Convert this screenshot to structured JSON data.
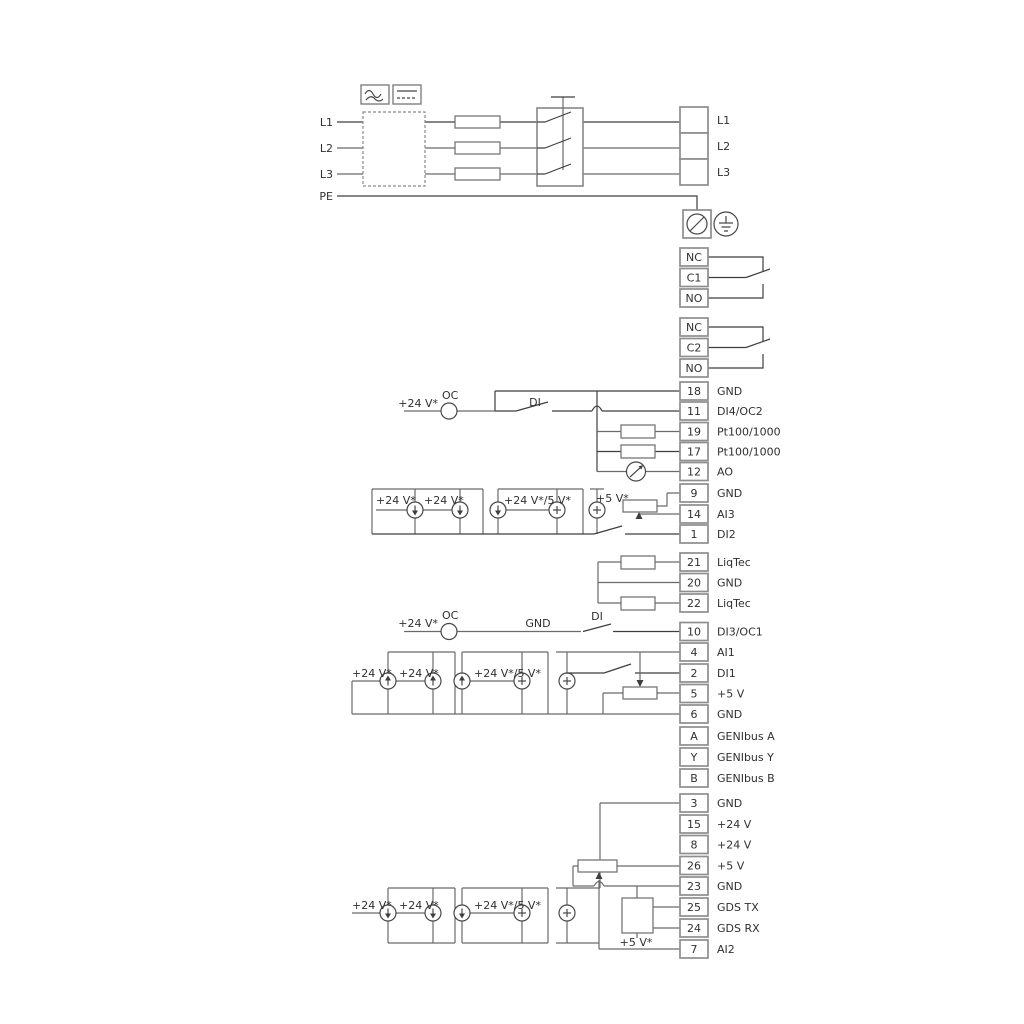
{
  "diagram": {
    "mains_input": {
      "l1": "L1",
      "l2": "L2",
      "l3": "L3",
      "pe": "PE"
    },
    "mains_output": {
      "items": [
        {
          "label": "L1"
        },
        {
          "label": "L2"
        },
        {
          "label": "L3"
        }
      ]
    },
    "relay1": {
      "items": [
        {
          "num": "NC"
        },
        {
          "num": "C1"
        },
        {
          "num": "NO"
        }
      ]
    },
    "relay2": {
      "items": [
        {
          "num": "NC"
        },
        {
          "num": "C2"
        },
        {
          "num": "NO"
        }
      ]
    },
    "io_a": {
      "items": [
        {
          "num": "18",
          "label": "GND"
        },
        {
          "num": "11",
          "label": "DI4/OC2"
        },
        {
          "num": "19",
          "label": "Pt100/1000"
        },
        {
          "num": "17",
          "label": "Pt100/1000"
        },
        {
          "num": "12",
          "label": "AO"
        },
        {
          "num": "9",
          "label": "GND"
        },
        {
          "num": "14",
          "label": "AI3"
        },
        {
          "num": "1",
          "label": "DI2"
        }
      ]
    },
    "liqtec": {
      "items": [
        {
          "num": "21",
          "label": "LiqTec"
        },
        {
          "num": "20",
          "label": "GND"
        },
        {
          "num": "22",
          "label": "LiqTec"
        }
      ]
    },
    "io_b": {
      "items": [
        {
          "num": "10",
          "label": "DI3/OC1"
        },
        {
          "num": "4",
          "label": "AI1"
        },
        {
          "num": "2",
          "label": "DI1"
        },
        {
          "num": "5",
          "label": "+5 V"
        },
        {
          "num": "6",
          "label": "GND"
        },
        {
          "num": "A",
          "label": "GENIbus A"
        },
        {
          "num": "Y",
          "label": "GENIbus Y"
        },
        {
          "num": "B",
          "label": "GENIbus B"
        }
      ]
    },
    "io_c": {
      "items": [
        {
          "num": "3",
          "label": "GND"
        },
        {
          "num": "15",
          "label": "+24 V"
        },
        {
          "num": "8",
          "label": "+24 V"
        },
        {
          "num": "26",
          "label": "+5 V"
        },
        {
          "num": "23",
          "label": "GND"
        },
        {
          "num": "25",
          "label": "GDS TX"
        },
        {
          "num": "24",
          "label": "GDS RX"
        },
        {
          "num": "7",
          "label": "AI2"
        }
      ]
    },
    "labels": {
      "a_24v": "+24 V*",
      "a_oc": "OC",
      "a_di": "DI",
      "b_s1": "+24 V*",
      "b_s2": "+24 V*",
      "b_s3": "+24 V*/5 V*",
      "b_5v": "+5 V*",
      "c_24v": "+24 V*",
      "c_oc": "OC",
      "c_gnd": "GND",
      "c_di": "DI",
      "c_s1": "+24 V*",
      "c_s2": "+24 V*",
      "c_s3": "+24 V*/5 V*",
      "d_s1": "+24 V*",
      "d_s2": "+24 V*",
      "d_s3": "+24 V*/5 V*",
      "d_5v": "+5 V*"
    },
    "colors": {
      "wire": "#6a6a6a",
      "wire_dark": "#3e3e3e",
      "box_border": "#8e8e8e",
      "text": "#303030"
    }
  }
}
